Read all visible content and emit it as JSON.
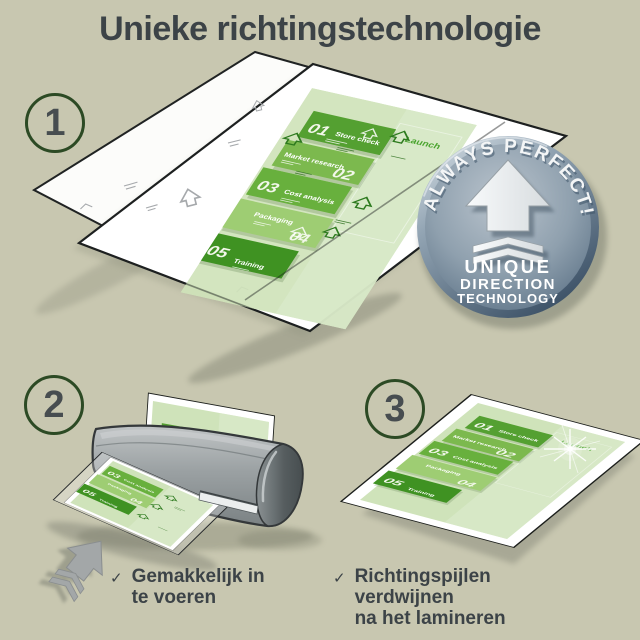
{
  "title": "Unieke richtingstechnologie",
  "steps": {
    "s1": "1",
    "s2": "2",
    "s3": "3"
  },
  "badge": {
    "arc_text": "ALWAYS PERFECT!",
    "line1": "UNIQUE",
    "line2": "DIRECTION",
    "line3": "TECHNOLOGY"
  },
  "doc": {
    "launch": "Launch",
    "items": [
      {
        "num": "01",
        "label": "Store check"
      },
      {
        "num": "02",
        "label": "Market research"
      },
      {
        "num": "03",
        "label": "Cost analysis"
      },
      {
        "num": "04",
        "label": "Packaging"
      },
      {
        "num": "05",
        "label": "Training"
      }
    ]
  },
  "bullets": [
    {
      "mark": "✓",
      "line1": "Gemakkelijk in",
      "line2": "te voeren"
    },
    {
      "mark": "✓",
      "line1": "Richtingspijlen verdwijnen",
      "line2": "na het lamineren"
    }
  ],
  "colors": {
    "background": "#c8c7b0",
    "text": "#3c4347",
    "circle_stroke": "#2c4a24",
    "doc_page_green": "#cfe3ba",
    "block_green_dark": "#3f9222",
    "block_green_mid": "#68b03d",
    "block_green_light": "#9ecd73",
    "badge_steel": "#8fa0ae",
    "laminator_gray": "#9ba1a3"
  }
}
